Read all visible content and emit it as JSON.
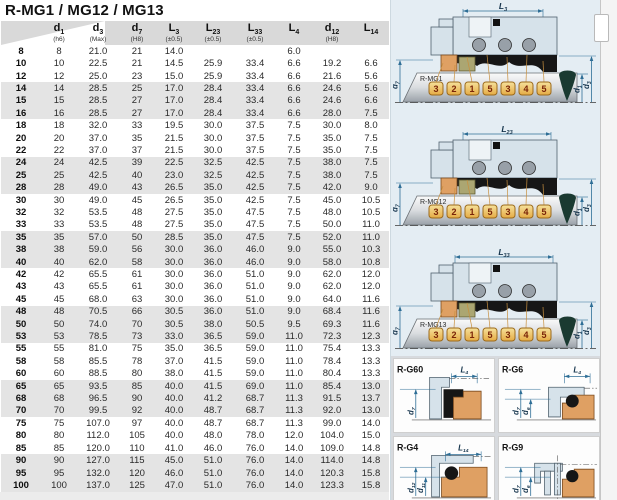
{
  "title": "R-MG1 / MG12 / MG13",
  "table": {
    "columns": [
      {
        "sym": "",
        "sub": "",
        "tol": ""
      },
      {
        "sym": "d",
        "sub": "1",
        "tol": "(h6)"
      },
      {
        "sym": "d",
        "sub": "3",
        "tol": "(Max)"
      },
      {
        "sym": "d",
        "sub": "7",
        "tol": "(H8)"
      },
      {
        "sym": "L",
        "sub": "3",
        "tol": "(±0.5)"
      },
      {
        "sym": "L",
        "sub": "23",
        "tol": "(±0.5)"
      },
      {
        "sym": "L",
        "sub": "33",
        "tol": "(±0.5)"
      },
      {
        "sym": "L",
        "sub": "4",
        "tol": ""
      },
      {
        "sym": "d",
        "sub": "12",
        "tol": "(H8)"
      },
      {
        "sym": "L",
        "sub": "14",
        "tol": ""
      }
    ],
    "rows": [
      [
        "8",
        "8",
        "21.0",
        "21",
        "14.0",
        "",
        "",
        "6.0",
        "",
        ""
      ],
      [
        "10",
        "10",
        "22.5",
        "21",
        "14.5",
        "25.9",
        "33.4",
        "6.6",
        "19.2",
        "6.6"
      ],
      [
        "12",
        "12",
        "25.0",
        "23",
        "15.0",
        "25.9",
        "33.4",
        "6.6",
        "21.6",
        "5.6"
      ],
      [
        "14",
        "14",
        "28.5",
        "25",
        "17.0",
        "28.4",
        "33.4",
        "6.6",
        "24.6",
        "5.6"
      ],
      [
        "15",
        "15",
        "28.5",
        "27",
        "17.0",
        "28.4",
        "33.4",
        "6.6",
        "24.6",
        "6.6"
      ],
      [
        "16",
        "16",
        "28.5",
        "27",
        "17.0",
        "28.4",
        "33.4",
        "6.6",
        "28.0",
        "7.5"
      ],
      [
        "18",
        "18",
        "32.0",
        "33",
        "19.5",
        "30.0",
        "37.5",
        "7.5",
        "30.0",
        "8.0"
      ],
      [
        "20",
        "20",
        "37.0",
        "35",
        "21.5",
        "30.0",
        "37.5",
        "7.5",
        "35.0",
        "7.5"
      ],
      [
        "22",
        "22",
        "37.0",
        "37",
        "21.5",
        "30.0",
        "37.5",
        "7.5",
        "35.0",
        "7.5"
      ],
      [
        "24",
        "24",
        "42.5",
        "39",
        "22.5",
        "32.5",
        "42.5",
        "7.5",
        "38.0",
        "7.5"
      ],
      [
        "25",
        "25",
        "42.5",
        "40",
        "23.0",
        "32.5",
        "42.5",
        "7.5",
        "38.0",
        "7.5"
      ],
      [
        "28",
        "28",
        "49.0",
        "43",
        "26.5",
        "35.0",
        "42.5",
        "7.5",
        "42.0",
        "9.0"
      ],
      [
        "30",
        "30",
        "49.0",
        "45",
        "26.5",
        "35.0",
        "42.5",
        "7.5",
        "45.0",
        "10.5"
      ],
      [
        "32",
        "32",
        "53.5",
        "48",
        "27.5",
        "35.0",
        "47.5",
        "7.5",
        "48.0",
        "10.5"
      ],
      [
        "33",
        "33",
        "53.5",
        "48",
        "27.5",
        "35.0",
        "47.5",
        "7.5",
        "50.0",
        "11.0"
      ],
      [
        "35",
        "35",
        "57.0",
        "50",
        "28.5",
        "35.0",
        "47.5",
        "7.5",
        "52.0",
        "11.0"
      ],
      [
        "38",
        "38",
        "59.0",
        "56",
        "30.0",
        "36.0",
        "46.0",
        "9.0",
        "55.0",
        "10.3"
      ],
      [
        "40",
        "40",
        "62.0",
        "58",
        "30.0",
        "36.0",
        "46.0",
        "9.0",
        "58.0",
        "10.8"
      ],
      [
        "42",
        "42",
        "65.5",
        "61",
        "30.0",
        "36.0",
        "51.0",
        "9.0",
        "62.0",
        "12.0"
      ],
      [
        "43",
        "43",
        "65.5",
        "61",
        "30.0",
        "36.0",
        "51.0",
        "9.0",
        "62.0",
        "12.0"
      ],
      [
        "45",
        "45",
        "68.0",
        "63",
        "30.0",
        "36.0",
        "51.0",
        "9.0",
        "64.0",
        "11.6"
      ],
      [
        "48",
        "48",
        "70.5",
        "66",
        "30.5",
        "36.0",
        "51.0",
        "9.0",
        "68.4",
        "11.6"
      ],
      [
        "50",
        "50",
        "74.0",
        "70",
        "30.5",
        "38.0",
        "50.5",
        "9.5",
        "69.3",
        "11.6"
      ],
      [
        "53",
        "53",
        "78.5",
        "73",
        "33.0",
        "36.5",
        "59.0",
        "11.0",
        "72.3",
        "12.3"
      ],
      [
        "55",
        "55",
        "81.0",
        "75",
        "35.0",
        "36.5",
        "59.0",
        "11.0",
        "75.4",
        "13.3"
      ],
      [
        "58",
        "58",
        "85.5",
        "78",
        "37.0",
        "41.5",
        "59.0",
        "11.0",
        "78.4",
        "13.3"
      ],
      [
        "60",
        "60",
        "88.5",
        "80",
        "38.0",
        "41.5",
        "59.0",
        "11.0",
        "80.4",
        "13.3"
      ],
      [
        "65",
        "65",
        "93.5",
        "85",
        "40.0",
        "41.5",
        "69.0",
        "11.0",
        "85.4",
        "13.0"
      ],
      [
        "68",
        "68",
        "96.5",
        "90",
        "40.0",
        "41.2",
        "68.7",
        "11.3",
        "91.5",
        "13.7"
      ],
      [
        "70",
        "70",
        "99.5",
        "92",
        "40.0",
        "48.7",
        "68.7",
        "11.3",
        "92.0",
        "13.0"
      ],
      [
        "75",
        "75",
        "107.0",
        "97",
        "40.0",
        "48.7",
        "68.7",
        "11.3",
        "99.0",
        "14.0"
      ],
      [
        "80",
        "80",
        "112.0",
        "105",
        "40.0",
        "48.0",
        "78.0",
        "12.0",
        "104.0",
        "15.0"
      ],
      [
        "85",
        "85",
        "120.0",
        "110",
        "41.0",
        "46.0",
        "76.0",
        "14.0",
        "109.0",
        "14.8"
      ],
      [
        "90",
        "90",
        "127.0",
        "115",
        "45.0",
        "51.0",
        "76.0",
        "14.0",
        "114.0",
        "14.8"
      ],
      [
        "95",
        "95",
        "132.0",
        "120",
        "46.0",
        "51.0",
        "76.0",
        "14.0",
        "120.3",
        "15.8"
      ],
      [
        "100",
        "100",
        "137.0",
        "125",
        "47.0",
        "51.0",
        "76.0",
        "14.0",
        "123.3",
        "15.8"
      ]
    ]
  },
  "diagrams": {
    "callouts": [
      "3",
      "2",
      "1",
      "5",
      "3",
      "4",
      "5"
    ],
    "main": [
      {
        "label": "R-MG1",
        "top_dim": {
          "sym": "L",
          "sub": "3"
        },
        "left_dim": {
          "sym": "d",
          "sub": "7"
        },
        "right_dims": [
          {
            "sym": "d",
            "sub": "1"
          },
          {
            "sym": "d",
            "sub": "3"
          }
        ]
      },
      {
        "label": "R-MG12",
        "top_dim": {
          "sym": "L",
          "sub": "23"
        },
        "left_dim": {
          "sym": "d",
          "sub": "7"
        },
        "right_dims": [
          {
            "sym": "d",
            "sub": "1"
          },
          {
            "sym": "d",
            "sub": "3"
          }
        ]
      },
      {
        "label": "R-MG13",
        "top_dim": {
          "sym": "L",
          "sub": "33"
        },
        "left_dim": {
          "sym": "d",
          "sub": "7"
        },
        "right_dims": [
          {
            "sym": "d",
            "sub": "1"
          },
          {
            "sym": "d",
            "sub": "3"
          }
        ]
      }
    ],
    "small": [
      {
        "label": "R-G60",
        "style": "boot",
        "top_dim": {
          "sym": "L",
          "sub": "4"
        },
        "left_dims": [
          {
            "sym": "d",
            "sub": "7"
          }
        ]
      },
      {
        "label": "R-G6",
        "style": "oring",
        "top_dim": {
          "sym": "L",
          "sub": "4"
        },
        "left_dims": [
          {
            "sym": "d",
            "sub": "7"
          },
          {
            "sym": "d",
            "sub": "6"
          }
        ]
      },
      {
        "label": "R-G4",
        "style": "oring-large",
        "top_dim": {
          "sym": "L",
          "sub": "14"
        },
        "left_dims": [
          {
            "sym": "d",
            "sub": "12"
          },
          {
            "sym": "d",
            "sub": "11"
          }
        ]
      },
      {
        "label": "R-G9",
        "style": "oring-step",
        "top_dim": null,
        "left_dims": [
          {
            "sym": "d",
            "sub": "7"
          },
          {
            "sym": "d",
            "sub": "6"
          }
        ]
      }
    ]
  },
  "colors": {
    "dim_line": "#2e6e96",
    "dim_text": "#15344c",
    "housing": "#d6e2ea",
    "housing_stroke": "#51626e",
    "seat_orange": "#dfa063",
    "seat_stroke": "#7a4a1e",
    "collar_olive": "#aba672",
    "black_part": "#161616",
    "spring_gray": "#98a0a8",
    "callout_fill_top": "#f6e19b",
    "callout_fill_bottom": "#e5ab44",
    "callout_border": "#9c6a1c",
    "callout_text": "#7a2408",
    "teal_drop": "#1a3a31",
    "leader": "#c89040",
    "header_gray": "#d9d9d9",
    "band_gray": "#e4e4e4",
    "panel_bg": "#e4edf3"
  }
}
